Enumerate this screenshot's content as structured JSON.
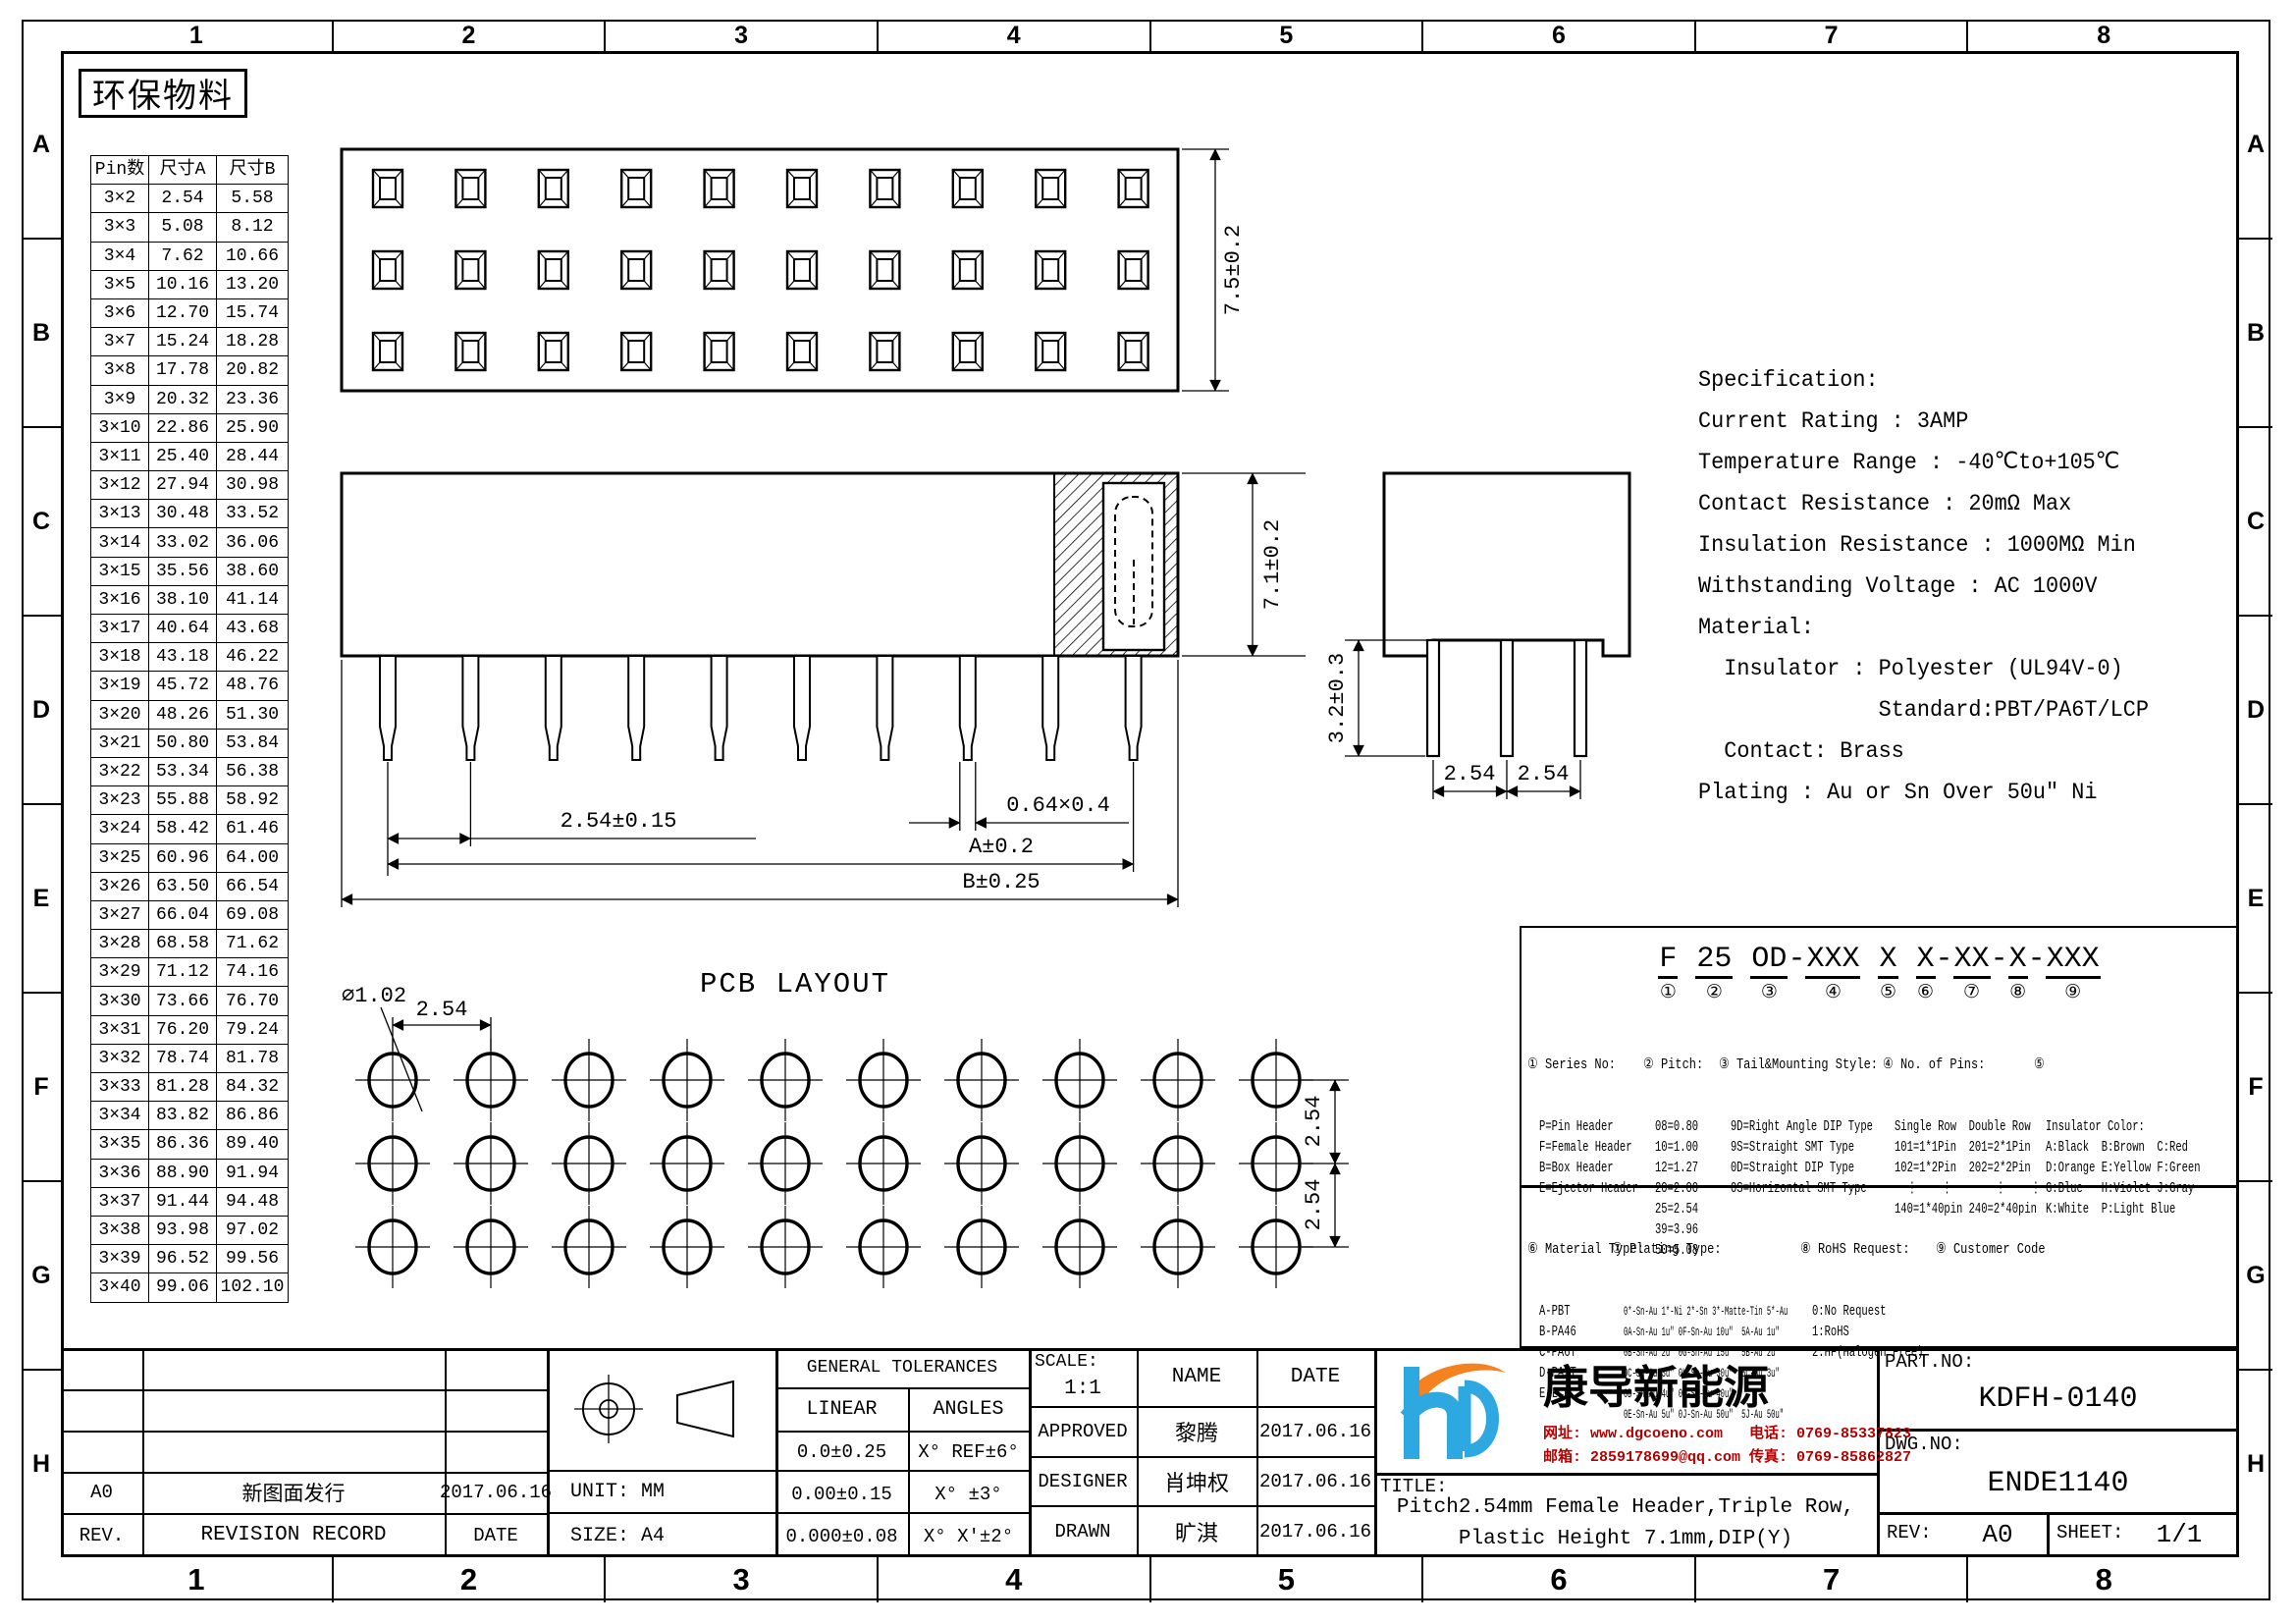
{
  "sheet": {
    "eco_label": "环保物料",
    "border_cols": [
      "1",
      "2",
      "3",
      "4",
      "5",
      "6",
      "7",
      "8"
    ],
    "border_rows": [
      "A",
      "B",
      "C",
      "D",
      "E",
      "F",
      "G",
      "H"
    ]
  },
  "pin_table": {
    "headers": [
      "Pin数",
      "尺寸A",
      "尺寸B"
    ],
    "rows": [
      {
        "pins": "3×2",
        "a": "2.54",
        "b": "5.58"
      },
      {
        "pins": "3×3",
        "a": "5.08",
        "b": "8.12"
      },
      {
        "pins": "3×4",
        "a": "7.62",
        "b": "10.66"
      },
      {
        "pins": "3×5",
        "a": "10.16",
        "b": "13.20"
      },
      {
        "pins": "3×6",
        "a": "12.70",
        "b": "15.74"
      },
      {
        "pins": "3×7",
        "a": "15.24",
        "b": "18.28"
      },
      {
        "pins": "3×8",
        "a": "17.78",
        "b": "20.82"
      },
      {
        "pins": "3×9",
        "a": "20.32",
        "b": "23.36"
      },
      {
        "pins": "3×10",
        "a": "22.86",
        "b": "25.90"
      },
      {
        "pins": "3×11",
        "a": "25.40",
        "b": "28.44"
      },
      {
        "pins": "3×12",
        "a": "27.94",
        "b": "30.98"
      },
      {
        "pins": "3×13",
        "a": "30.48",
        "b": "33.52"
      },
      {
        "pins": "3×14",
        "a": "33.02",
        "b": "36.06"
      },
      {
        "pins": "3×15",
        "a": "35.56",
        "b": "38.60"
      },
      {
        "pins": "3×16",
        "a": "38.10",
        "b": "41.14"
      },
      {
        "pins": "3×17",
        "a": "40.64",
        "b": "43.68"
      },
      {
        "pins": "3×18",
        "a": "43.18",
        "b": "46.22"
      },
      {
        "pins": "3×19",
        "a": "45.72",
        "b": "48.76"
      },
      {
        "pins": "3×20",
        "a": "48.26",
        "b": "51.30"
      },
      {
        "pins": "3×21",
        "a": "50.80",
        "b": "53.84"
      },
      {
        "pins": "3×22",
        "a": "53.34",
        "b": "56.38"
      },
      {
        "pins": "3×23",
        "a": "55.88",
        "b": "58.92"
      },
      {
        "pins": "3×24",
        "a": "58.42",
        "b": "61.46"
      },
      {
        "pins": "3×25",
        "a": "60.96",
        "b": "64.00"
      },
      {
        "pins": "3×26",
        "a": "63.50",
        "b": "66.54"
      },
      {
        "pins": "3×27",
        "a": "66.04",
        "b": "69.08"
      },
      {
        "pins": "3×28",
        "a": "68.58",
        "b": "71.62"
      },
      {
        "pins": "3×29",
        "a": "71.12",
        "b": "74.16"
      },
      {
        "pins": "3×30",
        "a": "73.66",
        "b": "76.70"
      },
      {
        "pins": "3×31",
        "a": "76.20",
        "b": "79.24"
      },
      {
        "pins": "3×32",
        "a": "78.74",
        "b": "81.78"
      },
      {
        "pins": "3×33",
        "a": "81.28",
        "b": "84.32"
      },
      {
        "pins": "3×34",
        "a": "83.82",
        "b": "86.86"
      },
      {
        "pins": "3×35",
        "a": "86.36",
        "b": "89.40"
      },
      {
        "pins": "3×36",
        "a": "88.90",
        "b": "91.94"
      },
      {
        "pins": "3×37",
        "a": "91.44",
        "b": "94.48"
      },
      {
        "pins": "3×38",
        "a": "93.98",
        "b": "97.02"
      },
      {
        "pins": "3×39",
        "a": "96.52",
        "b": "99.56"
      },
      {
        "pins": "3×40",
        "a": "99.06",
        "b": "102.10"
      }
    ]
  },
  "specification": {
    "lines": [
      "Specification:",
      "Current Rating : 3AMP",
      "Temperature Range : -40℃to+105℃",
      "Contact Resistance : 20mΩ Max",
      "Insulation Resistance : 1000MΩ Min",
      "Withstanding Voltage : AC 1000V",
      "Material:",
      "  Insulator : Polyester (UL94V-0)",
      "              Standard:PBT/PA6T/LCP",
      "  Contact: Brass",
      "Plating : Au or Sn Over 50u″ Ni"
    ]
  },
  "views": {
    "grid": {
      "rows": 3,
      "cols": 10,
      "end_cols": 3
    },
    "top": {
      "dim_height": "7.5±0.2"
    },
    "side": {
      "dim_pitch": "2.54±0.15",
      "dim_pin": "0.64×0.4",
      "dim_a": "A±0.2",
      "dim_b": "B±0.25",
      "dim_height": "7.1±0.2"
    },
    "end": {
      "dim_p1": "2.54",
      "dim_p2": "2.54",
      "dim_tail": "3.2±0.3"
    },
    "pcb": {
      "title": "PCB LAYOUT",
      "dim_pitch": "2.54",
      "dim_hole": "⌀1.02",
      "dim_v1": "2.54",
      "dim_v2": "2.54"
    }
  },
  "part_code": {
    "segments": [
      {
        "pre": "",
        "t": "F",
        "n": "①"
      },
      {
        "pre": " ",
        "t": "25",
        "n": "②"
      },
      {
        "pre": " ",
        "t": "OD",
        "n": "③"
      },
      {
        "pre": "-",
        "t": "XXX",
        "n": "④"
      },
      {
        "pre": " ",
        "t": "X",
        "n": "⑤"
      },
      {
        "pre": " ",
        "t": "X",
        "n": "⑥"
      },
      {
        "pre": "-",
        "t": "XX",
        "n": "⑦"
      },
      {
        "pre": "-",
        "t": "X",
        "n": "⑧"
      },
      {
        "pre": "-",
        "t": "XXX",
        "n": "⑨"
      }
    ]
  },
  "legend": {
    "series": {
      "title": "① Series No:",
      "items": [
        "P=Pin Header",
        "F=Female Header",
        "B=Box Header",
        "E=Ejector Header"
      ]
    },
    "pitch": {
      "title": "② Pitch:",
      "items": [
        "08=0.80",
        "10=1.00",
        "12=1.27",
        "20=2.00",
        "25=2.54",
        "39=3.96",
        "50=5.08"
      ]
    },
    "tail": {
      "title": "③ Tail&Mounting Style:",
      "items": [
        "9D=Right Angle DIP Type",
        "9S=Straight SMT Type",
        "0D=Straight DIP Type",
        "0S=Horizontal SMT Type"
      ]
    },
    "pins": {
      "title": "④ No. of Pins:",
      "items": [
        "Single Row  Double Row",
        "101=1*1Pin  201=2*1Pin",
        "102=1*2Pin  202=2*2Pin",
        "  ⋮    ⋮       ⋮    ⋮",
        "140=1*40pin 240=2*40pin"
      ]
    },
    "color": {
      "title": "⑤",
      "items": [
        "Insulator Color:",
        "A:Black  B:Brown  C:Red",
        "D:Orange E:Yellow F:Green",
        "G:Blue   H:Violet J:Gray",
        "K:White  P:Light Blue"
      ]
    },
    "material": {
      "title": "⑥ Material Type:",
      "items": [
        "A-PBT",
        "B-PA46",
        "C-PA6T",
        "D-PA9T",
        "E-LCP"
      ]
    },
    "plating": {
      "title": "⑦ Plating Type:",
      "items": [
        "0*-Sn-Au 1*-Ni 2*-Sn 3*-Matte-Tin 5*-Au",
        "0A-Sn-Au 1u″ 0F-Sn-Au 10u″  5A-Au 1u″",
        "0B-Sn-Au 2u″ 0G-Sn-Au 15u″  5B-Au 2u″",
        "0C-Sn-Au 3u″ 0H-Sn-Au 30u″  5C-Au 3u″",
        "0D-Sn-Au 4u″ 0I-Sn-Au 40u″      ⋮",
        "0E-Sn-Au 5u″ 0J-Sn-Au 50u″  5J-Au 50u″"
      ]
    },
    "rohs": {
      "title": "⑧ RoHS Request:",
      "items": [
        "0:No Request",
        "1:RoHS",
        "2:HF(Halogen Free)"
      ]
    },
    "customer": {
      "title": "⑨ Customer Code",
      "items": []
    }
  },
  "logo": {
    "company": "康导新能源",
    "line1": "网址: www.dgcoeno.com   电话: 0769-85337823",
    "line2": "邮箱: 2859178699@qq.com 传真: 0769-85862827",
    "colors": {
      "blue": "#2ea8e0",
      "orange": "#f5821f",
      "contact_red": "#b30000"
    }
  },
  "title_block": {
    "rev_col_headers": [
      "REV.",
      "REVISION RECORD",
      "DATE"
    ],
    "revision_rows": [
      {
        "rev": "A0",
        "record": "新图面发行",
        "date": "2017.06.16"
      }
    ],
    "unit": "UNIT: MM",
    "size": "SIZE: A4",
    "general_tolerances": "GENERAL TOLERANCES",
    "linear": "LINEAR",
    "angles": "ANGLES",
    "tolerance_rows": [
      {
        "linear": "0.0±0.25",
        "angle": "X° REF±6°"
      },
      {
        "linear": "0.00±0.15",
        "angle": "X° ±3°"
      },
      {
        "linear": "0.000±0.08",
        "angle": "X° X'±2°"
      }
    ],
    "scale_label": "SCALE:",
    "scale_value": "1:1",
    "name_header": "NAME",
    "date_header": "DATE",
    "approval_rows": [
      {
        "role": "APPROVED",
        "name": "黎腾",
        "date": "2017.06.16"
      },
      {
        "role": "DESIGNER",
        "name": "肖坤权",
        "date": "2017.06.16"
      },
      {
        "role": "DRAWN",
        "name": "旷淇",
        "date": "2017.06.16"
      }
    ],
    "title_label": "TITLE:",
    "title_line1": "Pitch2.54mm Female Header,Triple Row,",
    "title_line2": "Plastic Height 7.1mm,DIP(Y)",
    "part_no_label": "PART.NO:",
    "part_no": "KDFH-0140",
    "dwg_no_label": "DWG.NO:",
    "dwg_no": "ENDE1140",
    "rev_label": "REV:",
    "rev_value": "A0",
    "sheet_label": "SHEET:",
    "sheet_value": "1/1"
  }
}
